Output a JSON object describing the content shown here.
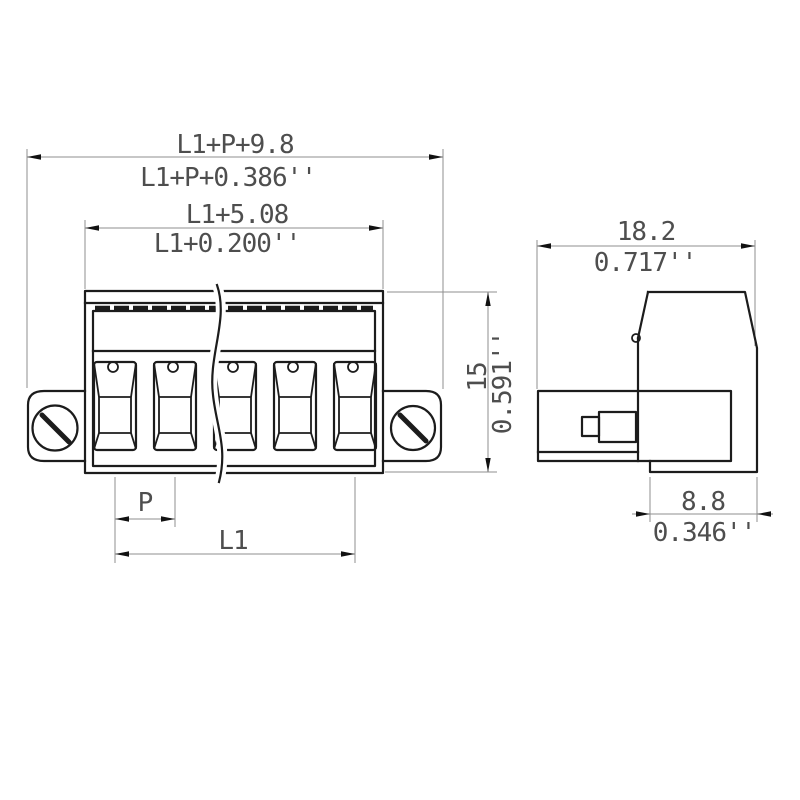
{
  "front_view": {
    "pole_count": 5,
    "dim_overall_width_mm": "L1+P+9.8",
    "dim_overall_width_in": "L1+P+0.386''",
    "dim_housing_width_mm": "L1+5.08",
    "dim_housing_width_in": "L1+0.200''",
    "dim_height_mm": "15",
    "dim_height_in": "0.591''",
    "dim_pitch_label": "P",
    "dim_length_label": "L1"
  },
  "side_view": {
    "dim_depth_mm": "18.2",
    "dim_depth_in": "0.717''",
    "dim_foot_depth_mm": "8.8",
    "dim_foot_depth_in": "0.346''"
  },
  "colors": {
    "object_line": "#1c1c1c",
    "dimension_line": "#8f8f8f",
    "text": "#4e4e4e",
    "background": "#ffffff"
  }
}
